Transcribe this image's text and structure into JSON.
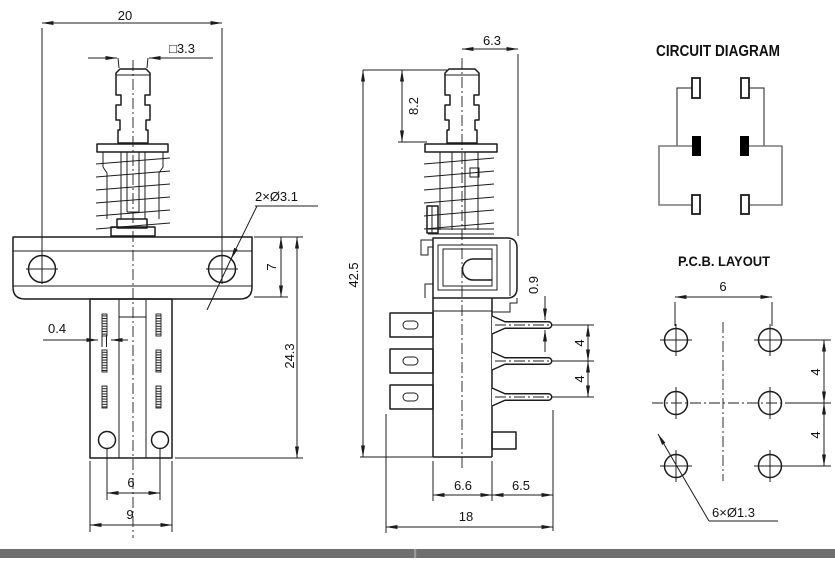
{
  "page": {
    "background": "#ffffff",
    "line_color": "#1c1c1c",
    "footer_bar_color": "#6f6f6f"
  },
  "front_view": {
    "dims": {
      "overall_width": "20",
      "plunger_square": "□3.3",
      "mounting_holes": "2×Ø3.1",
      "flange_height": "7",
      "body_height": "24.3",
      "terminal_thickness": "0.4",
      "hole_pitch": "6",
      "base_width": "9"
    }
  },
  "side_view": {
    "dims": {
      "top_offset": "6.3",
      "plunger_height": "8.2",
      "overall_height": "42.5",
      "pin_dia": "0.9",
      "pin_pitch_top": "4",
      "pin_pitch_bottom": "4",
      "body_depth": "6.6",
      "pin_length": "6.5",
      "overall_depth": "18"
    }
  },
  "circuit_diagram": {
    "title": "CIRCUIT DIAGRAM"
  },
  "pcb_layout": {
    "title": "P.C.B. LAYOUT",
    "dims": {
      "column_pitch": "6",
      "row_pitch_top": "4",
      "row_pitch_bottom": "4",
      "hole_spec": "6×Ø1.3"
    }
  }
}
